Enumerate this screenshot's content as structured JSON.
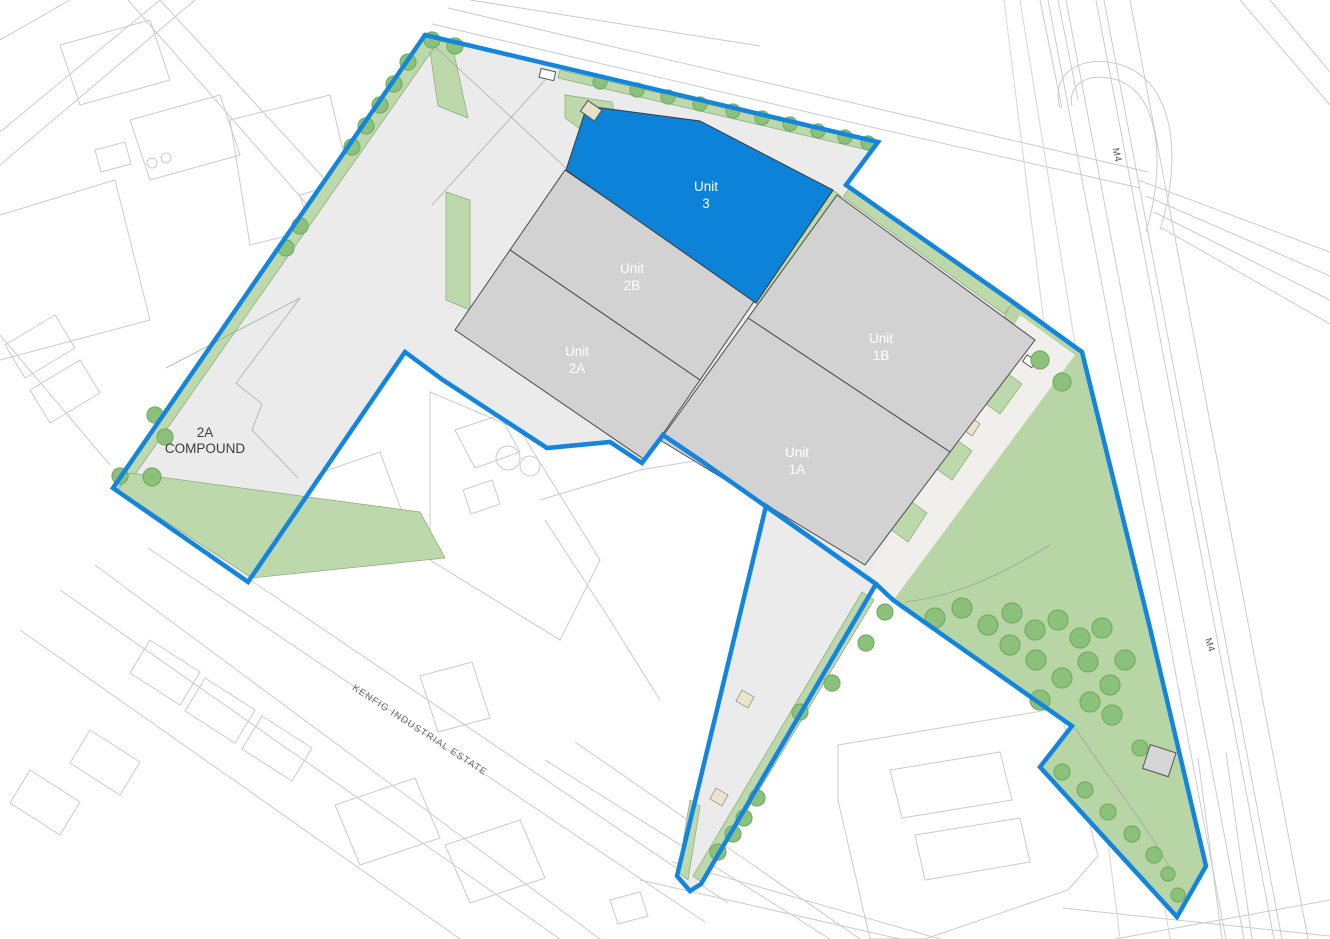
{
  "title": "Kenfig Industrial Estate site plan",
  "units": [
    {
      "id": "unit-3",
      "line1": "Unit",
      "line2": "3",
      "highlighted": true
    },
    {
      "id": "unit-2b",
      "line1": "Unit",
      "line2": "2B",
      "highlighted": false
    },
    {
      "id": "unit-2a",
      "line1": "Unit",
      "line2": "2A",
      "highlighted": false
    },
    {
      "id": "unit-1b",
      "line1": "Unit",
      "line2": "1B",
      "highlighted": false
    },
    {
      "id": "unit-1a",
      "line1": "Unit",
      "line2": "1A",
      "highlighted": false
    }
  ],
  "compound": {
    "line1": "2A",
    "line2": "COMPOUND"
  },
  "roads": {
    "kenfig": {
      "label": "KENFIG INDUSTRIAL ESTATE"
    },
    "m4_top": {
      "label": "M4"
    },
    "m4_bottom": {
      "label": "M4"
    }
  },
  "colors": {
    "boundary": "#1485dd",
    "unit_highlight": "#0c82d8",
    "building": "#d2d2d2",
    "site": "#ebebeb",
    "landscape": "#bdd9ac",
    "wedge_green": "#b7d5a5",
    "tree": "#8cc17c",
    "background_lines": "#cbcbcb"
  }
}
